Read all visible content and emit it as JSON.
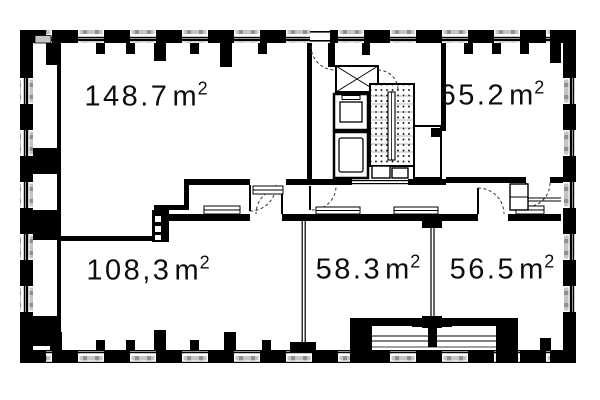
{
  "drawing": {
    "type": "architectural-floor-plan",
    "wall_color": "#000000",
    "window_shade_light": "#c4c4c4",
    "window_shade_dark": "#8f8f8f",
    "background": "#ffffff"
  },
  "rooms": [
    {
      "position": "top-left",
      "area": "148.7",
      "unit": "m",
      "unit_exponent": "2"
    },
    {
      "position": "top-right",
      "area": "65.2",
      "unit": "m",
      "unit_exponent": "2"
    },
    {
      "position": "bottom-left",
      "area": "108,3",
      "unit": "m",
      "unit_exponent": "2"
    },
    {
      "position": "bottom-center",
      "area": "58.3",
      "unit": "m",
      "unit_exponent": "2"
    },
    {
      "position": "bottom-right",
      "area": "56.5",
      "unit": "m",
      "unit_exponent": "2"
    }
  ]
}
